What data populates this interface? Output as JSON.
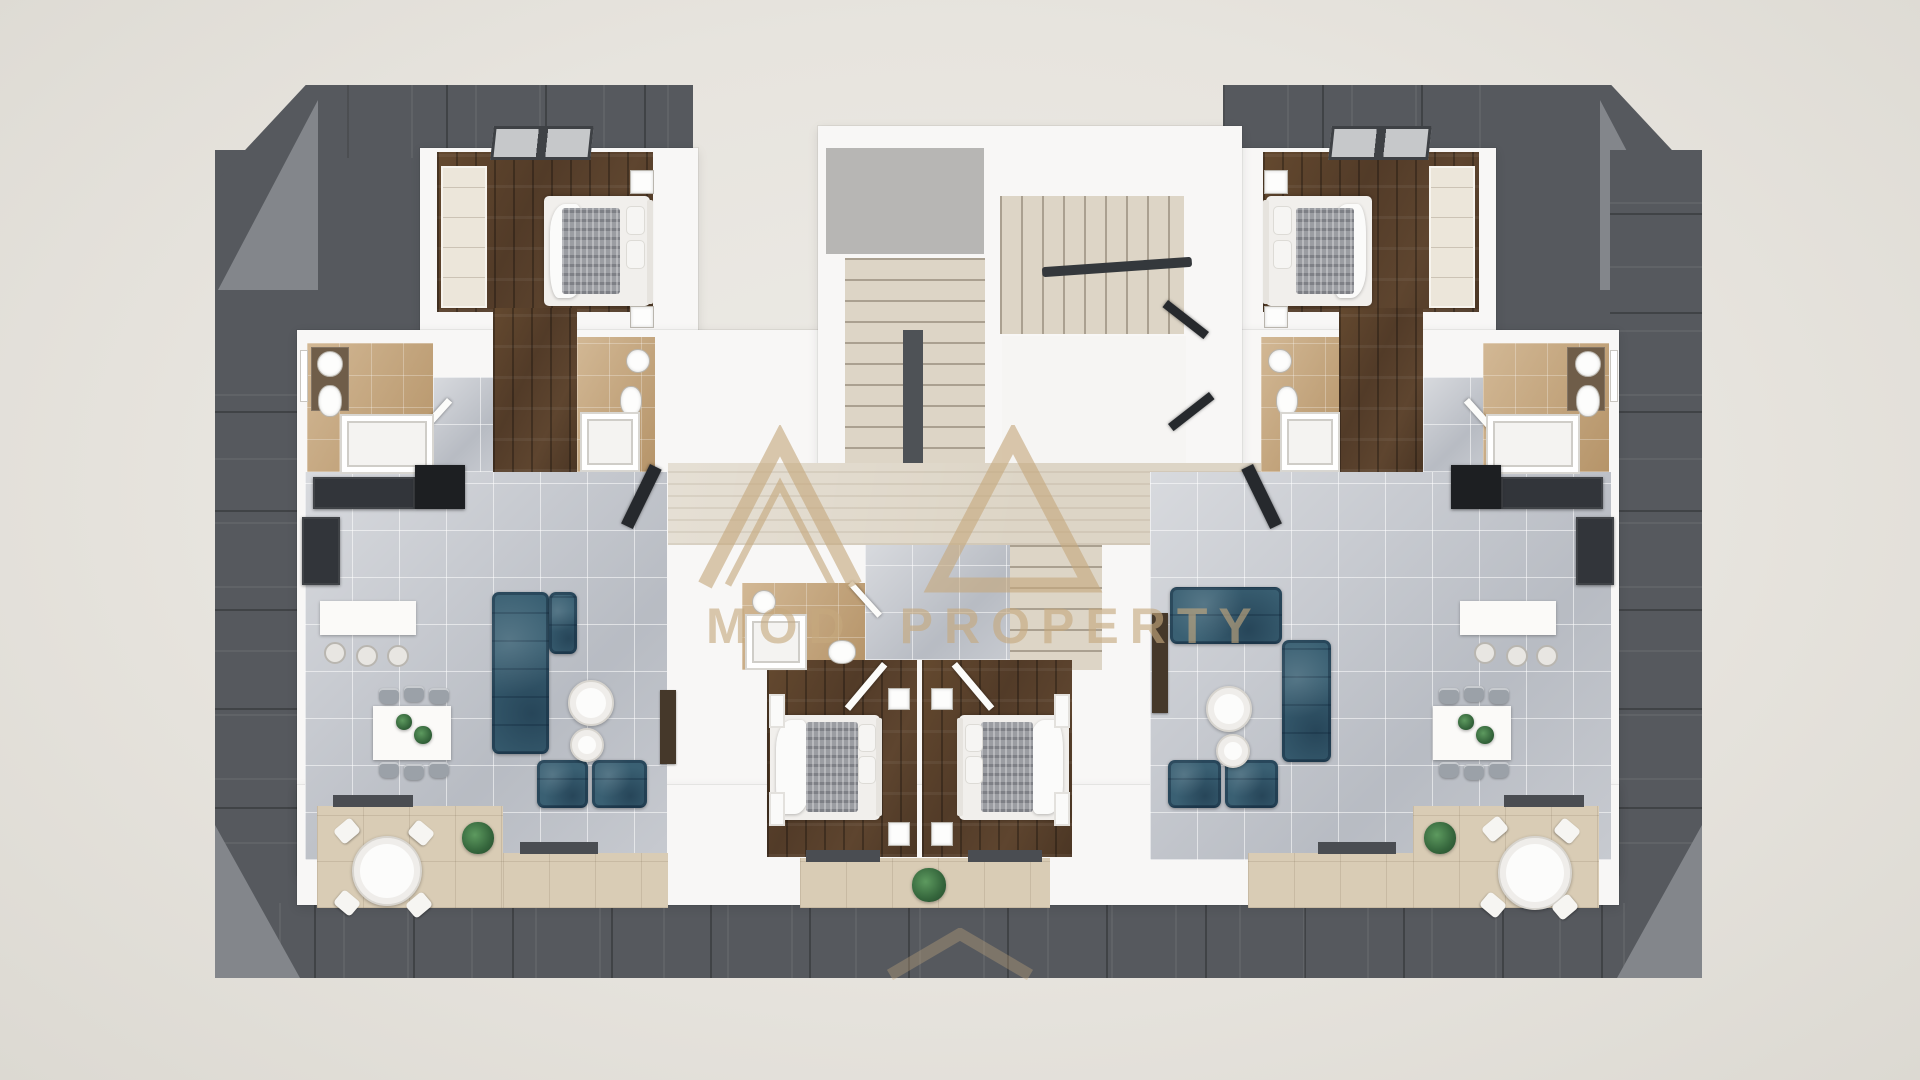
{
  "scene": {
    "description": "Top-down 3D architectural render of one residential floor: two mirrored apartments flanking a central switchback staircase, dark mansard roof ring around the footprint, balconies along the bottom edge",
    "view": "top-down orthographic 3d render"
  },
  "watermark": {
    "word1": "MOD",
    "word2": "PROPERTY",
    "logo": "twin-peak-triangle-monogram",
    "color": "#c6a97e",
    "note_word1_partially_obscured": true
  },
  "palette": {
    "background": "#e7e4de",
    "roof_dark": "#56595e",
    "roof_slope": "#83868b",
    "walls_white": "#f8f7f6",
    "tile_gray": "#c7cad0",
    "travertine": "#ddd5c6",
    "wood_floor": "#59412e",
    "bathroom_tan": "#c7a67a",
    "terrace_beige": "#d9ccb5",
    "sofa_navy": "#3a6073",
    "plant_green": "#35663c",
    "wardrobe_cream": "#ece6da"
  },
  "building": {
    "shared_core": [
      "central staircase, two flights with dark divider wall",
      "dark handrail",
      "white landing",
      "stairs continuing down to lower floor",
      "travertine entrance hallway",
      "open dark apartment doors"
    ],
    "left_apartment": {
      "rooms": [
        "bedroom top-left with wood floor and skylights",
        "en-suite bathroom",
        "family bathroom on left edge with window",
        "gray-tile entry strip",
        "open living-dining-kitchen on gray tile",
        "inner bathroom with shower, wc, washbasin",
        "second bedroom (center) with wood floor",
        "L-shaped terrace bottom-left",
        "small balcony strip off center bedroom"
      ],
      "furniture": [
        "double bed with gray throw and white duvet, two nightstands",
        "built-in cream wardrobe",
        "navy corner sofa",
        "two navy armchairs",
        "two round white coffee tables",
        "white dining table for six with plant centerpiece",
        "kitchen run with black fridge unit and island with three bar stools",
        "dark tv bench",
        "round white outdoor table with four chairs",
        "potted shrubs"
      ]
    },
    "right_apartment": {
      "layout": "mirror image of left apartment",
      "rooms": [
        "bedroom top-right with wood floor and skylights",
        "en-suite bathroom",
        "family bathroom on right edge with window",
        "gray-tile entry strip",
        "open living-dining-kitchen on gray tile",
        "second bedroom (center) with wood floor",
        "L-shaped terrace bottom-right"
      ],
      "furniture": [
        "double bed",
        "cream wardrobe",
        "navy sofa pair forming corner",
        "two navy armchairs",
        "round coffee tables",
        "dining table for six",
        "kitchen island with three stools",
        "round outdoor table with four chairs",
        "potted shrubs"
      ]
    }
  }
}
